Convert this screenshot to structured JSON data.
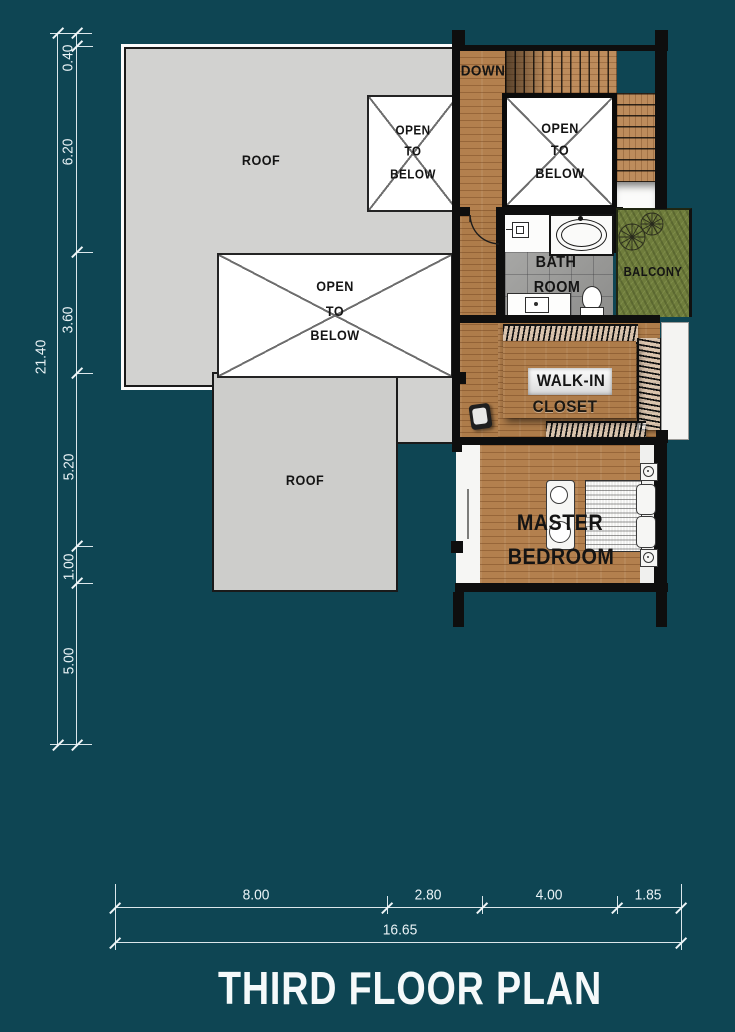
{
  "title": "THIRD FLOOR PLAN",
  "labels": {
    "roof": "ROOF",
    "open": {
      "l1": "OPEN",
      "l2": "TO",
      "l3": "BELOW"
    },
    "down": "DOWN",
    "bath": {
      "l1": "BATH",
      "l2": "ROOM"
    },
    "balcony": "BALCONY",
    "closet": {
      "l1": "WALK-IN",
      "l2": "CLOSET"
    },
    "master": {
      "l1": "MASTER",
      "l2": "BEDROOM"
    }
  },
  "dimensions": {
    "vertical": {
      "total": "21.40",
      "segments": [
        "0.40",
        "6.20",
        "3.60",
        "5.20",
        "1.00",
        "5.00"
      ]
    },
    "horizontal": {
      "total": "16.65",
      "segments": [
        "8.00",
        "2.80",
        "4.00",
        "1.85"
      ]
    }
  },
  "colors": {
    "background": "#0e4553",
    "roof": "#d2d2d0",
    "wood": "#b3804e",
    "tile": "#9d9d9b",
    "balcony_green": "#6f7d3c",
    "wall": "#0e0e0e",
    "dimension": "#e9f2f5"
  }
}
